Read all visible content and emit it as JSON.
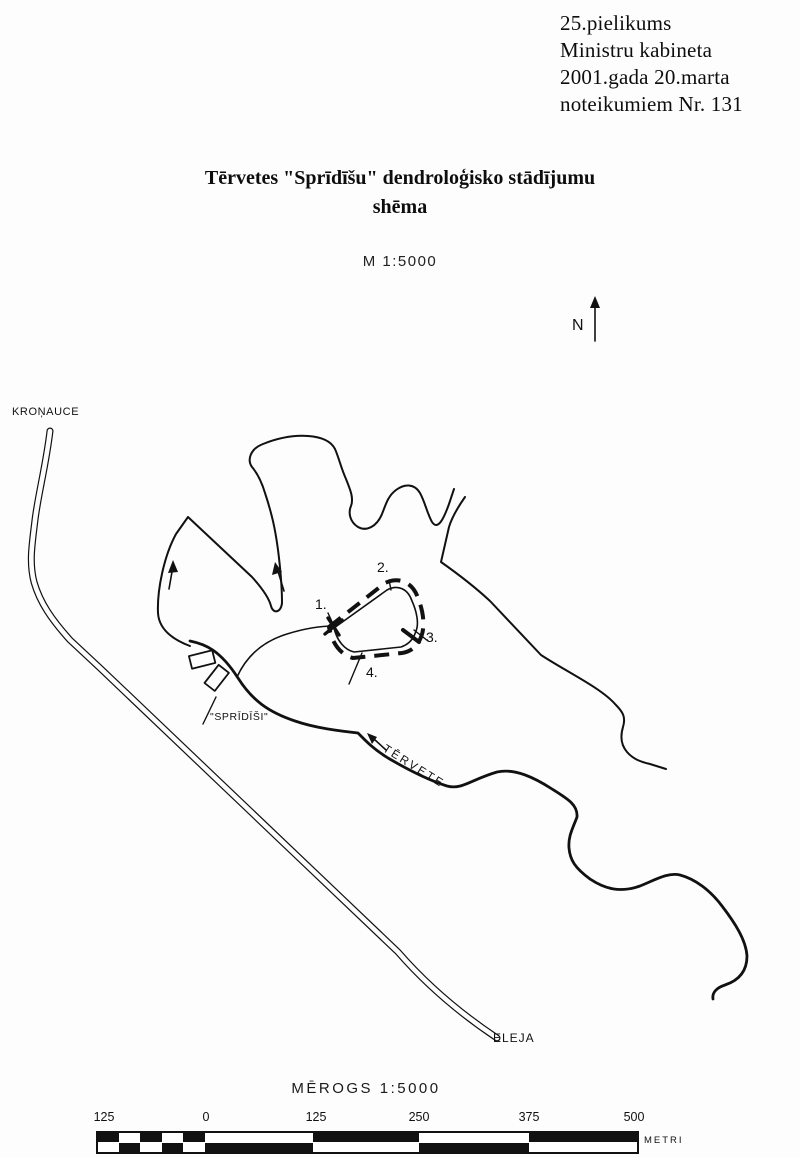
{
  "header": {
    "line1": "25.pielikums",
    "line2": "Ministru kabineta",
    "line3": "2001.gada 20.marta",
    "line4": "noteikumiem Nr. 131"
  },
  "title": {
    "line1": "Tērvetes \"Sprīdīšu\" dendroloģisko stādījumu",
    "line2": "shēma",
    "scale_note": "M 1:5000"
  },
  "compass": {
    "north_label": "N"
  },
  "map": {
    "labels": {
      "town_northwest": "KROŅAUCE",
      "homestead": "\"SPRĪDĪŠI\"",
      "river": "TĒRVETE",
      "town_southeast": "ELEJA"
    },
    "points": [
      "1.",
      "2.",
      "3.",
      "4."
    ]
  },
  "scalebar": {
    "title": "MĒROGS 1:5000",
    "ticks": [
      "125",
      "0",
      "125",
      "250",
      "375",
      "500"
    ],
    "unit": "METRI"
  },
  "colors": {
    "ink": "#111111",
    "paper": "#fdfdfd"
  }
}
